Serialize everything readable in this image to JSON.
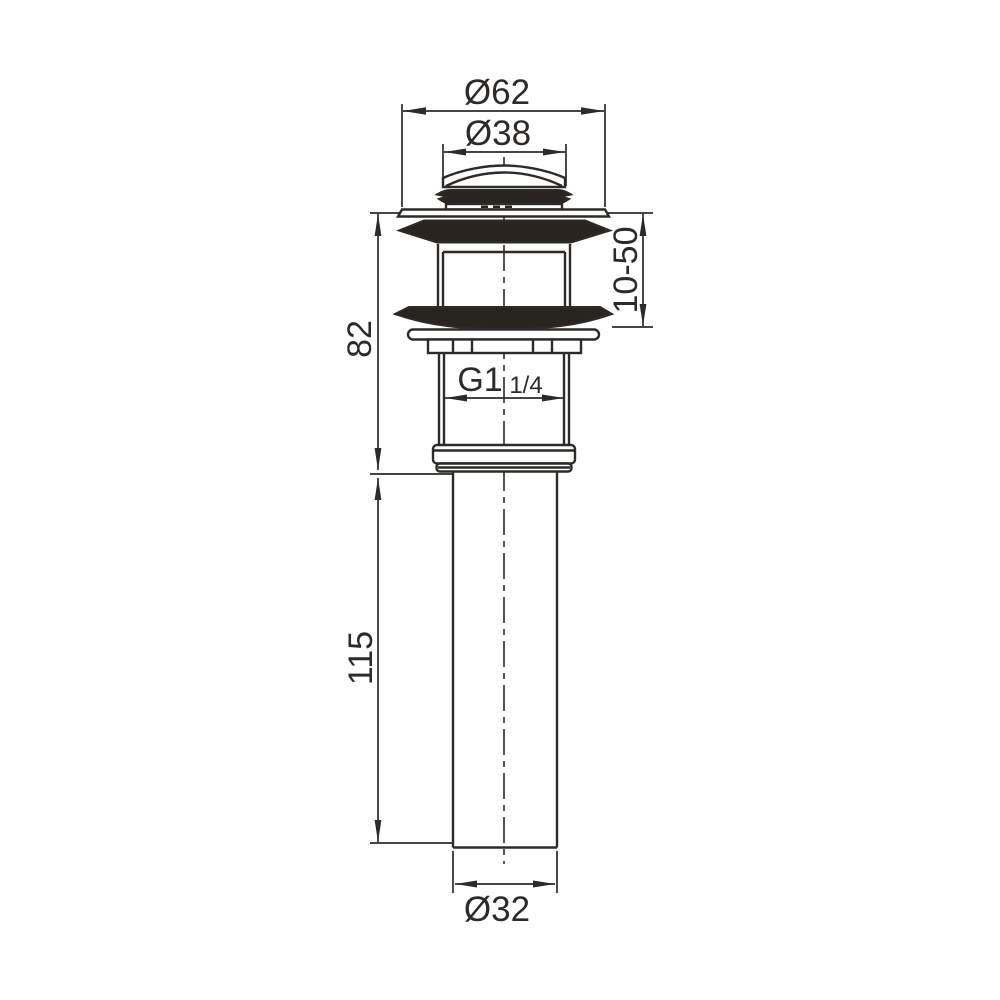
{
  "drawing": {
    "line_color": "#2d2a27",
    "dark_fill_color": "#2a2421",
    "background_color": "#ffffff",
    "dimensions": {
      "flange_diameter": "Ø62",
      "cap_diameter": "Ø38",
      "body_height": "82",
      "clamping_range": "10-50",
      "thread": "G1",
      "thread_fraction": "1/4",
      "tailpipe_length": "115",
      "tailpipe_diameter": "Ø32"
    }
  }
}
